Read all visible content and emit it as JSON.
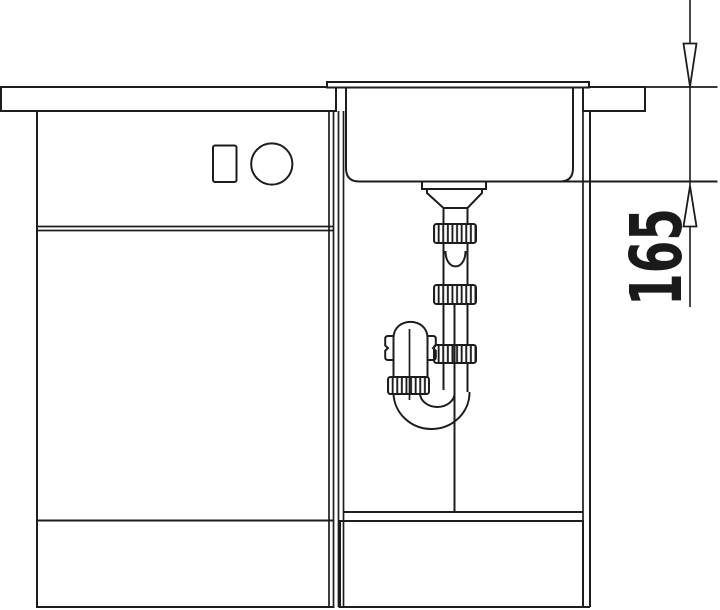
{
  "drawing": {
    "dimension_label": "165"
  },
  "colors": {
    "line": "#1d1d1b",
    "background": "#ffffff",
    "dimension_text": "#1a1a1a"
  }
}
